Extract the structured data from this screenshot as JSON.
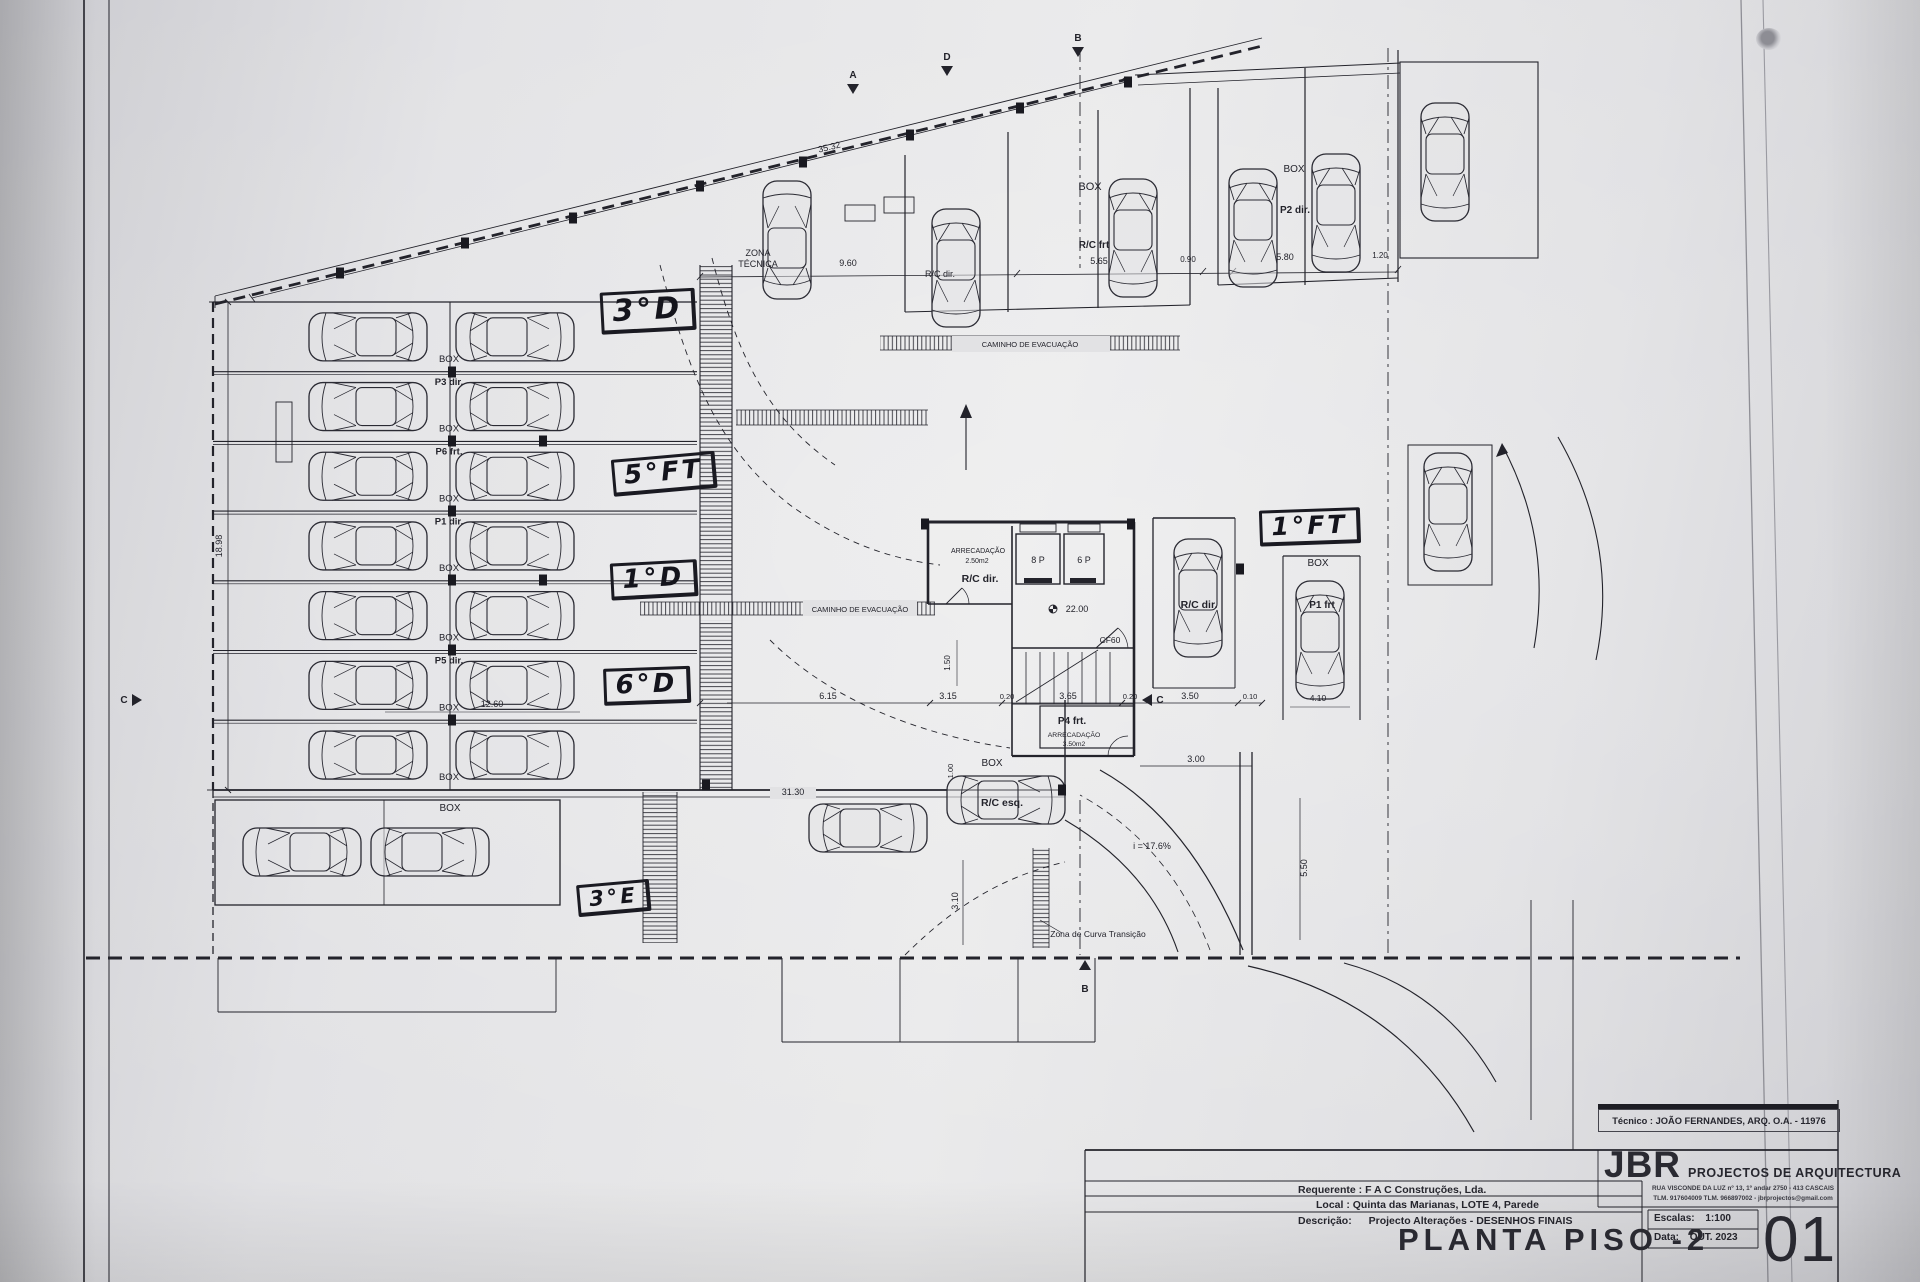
{
  "titleblock": {
    "tecnico": "Técnico : JOÃO FERNANDES, ARQ.   O.A. - 11976",
    "firm": "JBR",
    "firm_tag": "PROJECTOS DE ARQUITECTURA",
    "addr1": "RUA VISCONDE DA LUZ nº 13, 1º andar  2750 - 413 CASCAIS",
    "addr2": "TLM. 917604009  TLM. 966897002 - jbrprojectos@gmail.com",
    "requerente_label": "Requerente :",
    "requerente": "F A C  Construções, Lda.",
    "local_label": "Local :",
    "local": "Quinta das Marianas, LOTE 4, Parede",
    "descricao_label": "Descrição:",
    "descricao": "Projecto Alterações - DESENHOS FINAIS",
    "title": "PLANTA PISO -2",
    "escala_label": "Escalas:",
    "escala": "1:100",
    "data_label": "Data:",
    "data": "OUT. 2023",
    "sheet": "01"
  },
  "handwritten": [
    {
      "t": "3°D",
      "x": 648,
      "y": 311,
      "rot": -3,
      "fs": 30
    },
    {
      "t": "5°FT",
      "x": 664,
      "y": 474,
      "rot": -5,
      "fs": 26
    },
    {
      "t": "1°D",
      "x": 654,
      "y": 580,
      "rot": -3,
      "fs": 26
    },
    {
      "t": "6°D",
      "x": 647,
      "y": 686,
      "rot": -2,
      "fs": 26
    },
    {
      "t": "3°E",
      "x": 614,
      "y": 898,
      "rot": -5,
      "fs": 21
    },
    {
      "t": "1°FT",
      "x": 1310,
      "y": 527,
      "rot": -2,
      "fs": 25
    }
  ],
  "parking": {
    "rows": [
      {
        "box": "BOX",
        "p": "P3 dir."
      },
      {
        "box": "BOX",
        "p": "P6 frt."
      },
      {
        "box": "BOX",
        "p": "P1 dir."
      },
      {
        "box": "BOX",
        "p": ""
      },
      {
        "box": "BOX",
        "p": "P5 dir."
      },
      {
        "box": "BOX",
        "p": ""
      },
      {
        "box": "BOX",
        "p": ""
      }
    ]
  },
  "plan": {
    "labels": [
      {
        "t": "ZONA",
        "x": 758,
        "y": 256,
        "fs": 9
      },
      {
        "t": "TÉCNICA",
        "x": 758,
        "y": 267,
        "fs": 9
      },
      {
        "t": "35.32",
        "x": 830,
        "y": 150,
        "fs": 9,
        "rot": -13.8
      },
      {
        "t": "9.60",
        "x": 848,
        "y": 266,
        "fs": 9
      },
      {
        "t": "5.65",
        "x": 1099,
        "y": 264,
        "fs": 9
      },
      {
        "t": "0.90",
        "x": 1188,
        "y": 262,
        "fs": 8
      },
      {
        "t": "5.80",
        "x": 1285,
        "y": 260,
        "fs": 9
      },
      {
        "t": "1.20",
        "x": 1380,
        "y": 258,
        "fs": 8
      },
      {
        "t": "BOX",
        "x": 1090,
        "y": 190,
        "fs": 11
      },
      {
        "t": "R/C frt",
        "x": 1094,
        "y": 248,
        "fs": 10,
        "b": 1
      },
      {
        "t": "R/C dir.",
        "x": 940,
        "y": 277,
        "fs": 9
      },
      {
        "t": "BOX",
        "x": 1294,
        "y": 172,
        "fs": 10
      },
      {
        "t": "P2 dir.",
        "x": 1295,
        "y": 213,
        "fs": 10,
        "b": 1
      },
      {
        "t": "CAMINHO DE EVACUAÇÃO",
        "x": 1030,
        "y": 347,
        "fs": 7.5
      },
      {
        "t": "CAMINHO DE EVACUAÇÃO",
        "x": 860,
        "y": 612,
        "fs": 7.5
      },
      {
        "t": "ARRECADAÇÃO",
        "x": 978,
        "y": 553,
        "fs": 7
      },
      {
        "t": "2.50m2",
        "x": 977,
        "y": 563,
        "fs": 7
      },
      {
        "t": "R/C dir.",
        "x": 980,
        "y": 582,
        "fs": 10.5,
        "b": 1
      },
      {
        "t": "8 P",
        "x": 1038,
        "y": 563,
        "fs": 9
      },
      {
        "t": "6 P",
        "x": 1084,
        "y": 563,
        "fs": 9
      },
      {
        "t": "22.00",
        "x": 1077,
        "y": 612,
        "fs": 9
      },
      {
        "t": "CF60",
        "x": 1110,
        "y": 643,
        "fs": 8.5
      },
      {
        "t": "P4 frt.",
        "x": 1072,
        "y": 724,
        "fs": 10,
        "b": 1
      },
      {
        "t": "ARRECADAÇÃO",
        "x": 1074,
        "y": 737,
        "fs": 6.8
      },
      {
        "t": "3.50m2",
        "x": 1074,
        "y": 746,
        "fs": 6.8
      },
      {
        "t": "R/C dir.",
        "x": 1199,
        "y": 608,
        "fs": 10.5,
        "b": 1
      },
      {
        "t": "BOX",
        "x": 1318,
        "y": 566,
        "fs": 10
      },
      {
        "t": "P1 frt",
        "x": 1322,
        "y": 608,
        "fs": 10,
        "b": 1
      },
      {
        "t": "4.10",
        "x": 1318,
        "y": 701,
        "fs": 8.5
      },
      {
        "t": "BOX",
        "x": 992,
        "y": 766,
        "fs": 10
      },
      {
        "t": "R/C esq.",
        "x": 1002,
        "y": 806,
        "fs": 10.5,
        "b": 1
      },
      {
        "t": "i = 17.6%",
        "x": 1152,
        "y": 849,
        "fs": 9
      },
      {
        "t": "Zona de Curva Transição",
        "x": 1098,
        "y": 937,
        "fs": 8.5
      },
      {
        "t": "31.30",
        "x": 793,
        "y": 795,
        "fs": 9
      },
      {
        "t": "18.98",
        "x": 222,
        "y": 546,
        "fs": 9,
        "rot": -90
      },
      {
        "t": "12.60",
        "x": 492,
        "y": 707,
        "fs": 9
      },
      {
        "t": "6.15",
        "x": 828,
        "y": 699,
        "fs": 9
      },
      {
        "t": "3.15",
        "x": 948,
        "y": 699,
        "fs": 9
      },
      {
        "t": "0.20",
        "x": 1007,
        "y": 699,
        "fs": 7.5
      },
      {
        "t": "3.65",
        "x": 1068,
        "y": 699,
        "fs": 9
      },
      {
        "t": "0.20",
        "x": 1130,
        "y": 699,
        "fs": 7.5
      },
      {
        "t": "3.50",
        "x": 1190,
        "y": 699,
        "fs": 9
      },
      {
        "t": "0.10",
        "x": 1250,
        "y": 699,
        "fs": 7.5
      },
      {
        "t": "3.00",
        "x": 1196,
        "y": 762,
        "fs": 9
      },
      {
        "t": "5.50",
        "x": 1307,
        "y": 868,
        "fs": 9,
        "rot": -90
      },
      {
        "t": "3.10",
        "x": 958,
        "y": 901,
        "fs": 9,
        "rot": -90
      },
      {
        "t": "1.50",
        "x": 950,
        "y": 663,
        "fs": 8,
        "rot": -90
      },
      {
        "t": "1.00",
        "x": 953,
        "y": 771,
        "fs": 7.5,
        "rot": -90
      },
      {
        "t": "BOX",
        "x": 450,
        "y": 811,
        "fs": 10
      }
    ],
    "cars": [
      {
        "x": 787,
        "y": 240,
        "r": 180
      },
      {
        "x": 956,
        "y": 268,
        "r": 0
      },
      {
        "x": 1133,
        "y": 238,
        "r": 0
      },
      {
        "x": 1253,
        "y": 228,
        "r": 0
      },
      {
        "x": 1336,
        "y": 213,
        "r": 0
      },
      {
        "x": 1445,
        "y": 162,
        "r": 0
      },
      {
        "x": 1448,
        "y": 512,
        "r": 0
      },
      {
        "x": 1198,
        "y": 598,
        "r": 0
      },
      {
        "x": 1320,
        "y": 640,
        "r": 0
      },
      {
        "x": 1006,
        "y": 800,
        "r": -90
      },
      {
        "x": 868,
        "y": 828,
        "r": -90
      },
      {
        "x": 302,
        "y": 852,
        "r": 90
      },
      {
        "x": 430,
        "y": 852,
        "r": -90
      }
    ],
    "sections": [
      {
        "t": "A",
        "x": 853,
        "y": 78,
        "dir": "down"
      },
      {
        "t": "D",
        "x": 947,
        "y": 60,
        "dir": "down"
      },
      {
        "t": "B",
        "x": 1078,
        "y": 41,
        "dir": "down"
      },
      {
        "t": "C",
        "x": 124,
        "y": 703,
        "dir": "right"
      },
      {
        "t": "C",
        "x": 1160,
        "y": 703,
        "dir": "left"
      },
      {
        "t": "B",
        "x": 1085,
        "y": 992,
        "dir": "up"
      }
    ]
  }
}
